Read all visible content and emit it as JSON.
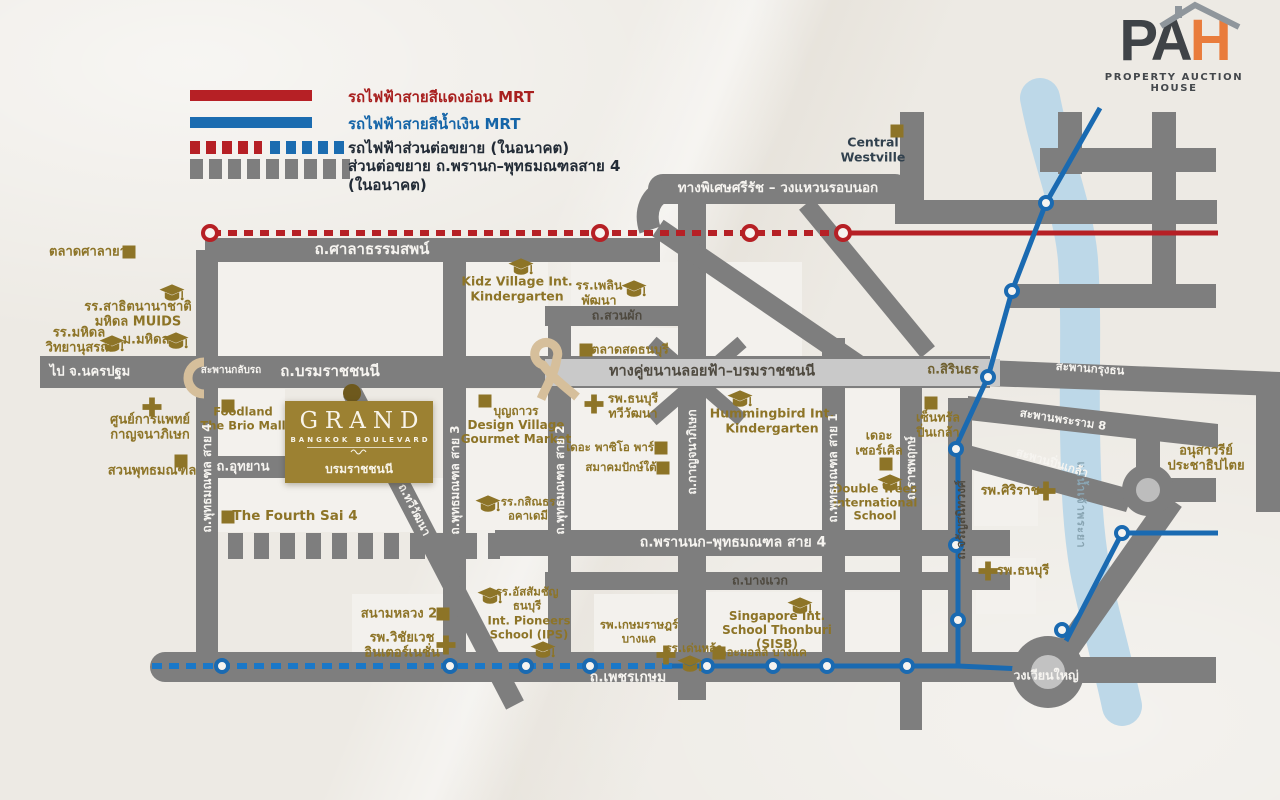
{
  "logo": {
    "part1": "PA",
    "part2": "H",
    "subtitle": "PROPERTY AUCTION HOUSE"
  },
  "legend": {
    "items": [
      {
        "id": "legend-red-line",
        "label": "รถไฟฟ้าสายสีแดงอ่อน MRT"
      },
      {
        "id": "legend-blue-line",
        "label": "รถไฟฟ้าสายสีน้ำเงิน MRT"
      },
      {
        "id": "legend-future-rail-extension",
        "label": "รถไฟฟ้าส่วนต่อขยาย (ในอนาคต)"
      },
      {
        "id": "legend-road-extension",
        "label": "ส่วนต่อขยาย ถ.พรานก–พุทธมณฑลสาย 4\n(ในอนาคต)"
      }
    ]
  },
  "project": {
    "name": "GRAND",
    "tagline": "BANGKOK BOULEVARD",
    "location": "บรมราชชนนี"
  },
  "colors": {
    "red_line": "#b62025",
    "blue_line": "#1a6ab1",
    "blue_line_future": "#1a78c8",
    "road": "#7e7e7e",
    "elevated_road": "#c9c9c9",
    "river": "#bdd8e8",
    "gold": "#8d7427",
    "project_box": "#9c8132",
    "logo_orange": "#e97c3c",
    "logo_dark": "#3f4347",
    "background": "#edeae4"
  },
  "map": {
    "labels": [
      {
        "id": "label-talad-salaya",
        "t": [
          "ตลาดศาลายา"
        ],
        "x": 88,
        "y": 252,
        "fs": 13,
        "cls": "gold"
      },
      {
        "id": "label-satit-muids",
        "t": [
          "รร.สาธิตนานาชาติ",
          "มหิดล MUIDS"
        ],
        "x": 138,
        "y": 315,
        "fs": 13,
        "cls": "gold"
      },
      {
        "id": "label-mahidol-wittayanusorn",
        "t": [
          "รร.มหิดล",
          "วิทยานุสรณ์"
        ],
        "x": 79,
        "y": 341,
        "fs": 13,
        "cls": "gold"
      },
      {
        "id": "label-mahidol-university",
        "t": [
          "ม.มหิดล"
        ],
        "x": 146,
        "y": 340,
        "fs": 13,
        "cls": "gold"
      },
      {
        "id": "label-road-salathammasop",
        "t": [
          "ถ.ศาลาธรรมสพน์"
        ],
        "x": 372,
        "y": 250,
        "fs": 15,
        "cls": "white"
      },
      {
        "id": "label-to-nakhonpathom",
        "t": [
          "ไป จ.นครปฐม"
        ],
        "x": 90,
        "y": 372,
        "fs": 13,
        "cls": "white"
      },
      {
        "id": "label-uturn-bridge",
        "t": [
          "สะพานกลับรถ"
        ],
        "x": 231,
        "y": 371,
        "fs": 10,
        "cls": "white"
      },
      {
        "id": "label-road-borommaratchachonnani",
        "t": [
          "ถ.บรมราชชนนี"
        ],
        "x": 330,
        "y": 372,
        "fs": 15,
        "cls": "white"
      },
      {
        "id": "label-kanchanaphisek-medical-center",
        "t": [
          "ศูนย์การแพทย์",
          "กาญจนาภิเษก"
        ],
        "x": 150,
        "y": 428,
        "fs": 13,
        "cls": "gold"
      },
      {
        "id": "label-phutthamonthon-park",
        "t": [
          "สวนพุทธมณฑล"
        ],
        "x": 152,
        "y": 471,
        "fs": 13,
        "cls": "gold"
      },
      {
        "id": "label-foodland-brio-mall",
        "t": [
          "Foodland",
          "The Brio Mall"
        ],
        "x": 243,
        "y": 419,
        "fs": 11.5,
        "cls": "gold"
      },
      {
        "id": "label-road-phutthamonthon-sai4",
        "t": [
          "ถ.พุทธมณฑล สาย 4"
        ],
        "x": 207,
        "y": 478,
        "fs": 12,
        "cls": "white",
        "rot": -90
      },
      {
        "id": "label-road-utthayan",
        "t": [
          "ถ.อุทยาน"
        ],
        "x": 243,
        "y": 467,
        "fs": 13,
        "cls": "white"
      },
      {
        "id": "label-the-fourth-sai4",
        "t": [
          "The Fourth Sai 4"
        ],
        "x": 295,
        "y": 517,
        "fs": 13.5,
        "cls": "gold"
      },
      {
        "id": "label-boonthavorn-design-village",
        "t": [
          "บุญถาวร",
          "Design Village",
          "Gourmet Market"
        ],
        "x": 516,
        "y": 425,
        "fs": 12,
        "cls": "gold"
      },
      {
        "id": "label-road-phutthamonthon-sai3",
        "t": [
          "ถ.พุทธมณฑล สาย 3"
        ],
        "x": 455,
        "y": 480,
        "fs": 12,
        "cls": "white",
        "rot": -90
      },
      {
        "id": "label-kasintorn-academy",
        "t": [
          "รร.กสิณธร",
          "อคาเดมี"
        ],
        "x": 528,
        "y": 509,
        "fs": 11.5,
        "cls": "gold"
      },
      {
        "id": "label-kidz-village",
        "t": [
          "Kidz Village Int.",
          "Kindergarten"
        ],
        "x": 517,
        "y": 289,
        "fs": 12.5,
        "cls": "gold"
      },
      {
        "id": "label-plearnpattana-school",
        "t": [
          "รร.เพลิน",
          "พัฒนา"
        ],
        "x": 599,
        "y": 293,
        "fs": 12.5,
        "cls": "gold"
      },
      {
        "id": "label-road-suanphak",
        "t": [
          "ถ.สวนผัก"
        ],
        "x": 617,
        "y": 316,
        "fs": 12.5,
        "cls": "dark"
      },
      {
        "id": "label-talad-sod-thonburi",
        "t": [
          "ตลาดสดธนบุรี"
        ],
        "x": 630,
        "y": 350,
        "fs": 12.5,
        "cls": "gold"
      },
      {
        "id": "label-elevated-parallel-road",
        "t": [
          "ทางคู่ขนานลอยฟ้า–บรมราชชนนี"
        ],
        "x": 712,
        "y": 372,
        "fs": 14.5,
        "cls": "dark"
      },
      {
        "id": "label-road-sirindhorn",
        "t": [
          "ถ.สิรินธร"
        ],
        "x": 953,
        "y": 370,
        "fs": 13,
        "cls": "goldd"
      },
      {
        "id": "label-thonburi-thawiwatthana-hospital",
        "t": [
          "รพ.ธนบุรี",
          "ทวีวัฒนา"
        ],
        "x": 633,
        "y": 406,
        "fs": 12.5,
        "cls": "gold"
      },
      {
        "id": "label-the-paseo-park",
        "t": [
          "เดอะ พาซิโอ พาร์ค"
        ],
        "x": 614,
        "y": 448,
        "fs": 11.5,
        "cls": "gold"
      },
      {
        "id": "label-southern-association",
        "t": [
          "สมาคมปักษ์ใต้"
        ],
        "x": 621,
        "y": 468,
        "fs": 11.5,
        "cls": "gold"
      },
      {
        "id": "label-road-phutthamonthon-sai2",
        "t": [
          "ถ.พุทธมณฑล สาย 2"
        ],
        "x": 560,
        "y": 480,
        "fs": 12,
        "cls": "white",
        "rot": -90
      },
      {
        "id": "label-road-kanchanaphisek",
        "t": [
          "ถ.กาญจนาภิเษก"
        ],
        "x": 692,
        "y": 452,
        "fs": 12,
        "cls": "white",
        "rot": -90
      },
      {
        "id": "label-hummingbird-kindergarten",
        "t": [
          "Hummingbird Int.",
          "Kindergarten"
        ],
        "x": 772,
        "y": 421,
        "fs": 12.5,
        "cls": "gold"
      },
      {
        "id": "label-the-circle",
        "t": [
          "เดอะ",
          "เซอร์เคิล"
        ],
        "x": 879,
        "y": 443,
        "fs": 12.5,
        "cls": "gold"
      },
      {
        "id": "label-double-trees-school",
        "t": [
          "Double Trees",
          "International",
          "School"
        ],
        "x": 875,
        "y": 503,
        "fs": 11.5,
        "cls": "gold"
      },
      {
        "id": "label-road-phutthamonthon-sai1",
        "t": [
          "ถ.พุทธมณฑล สาย 1"
        ],
        "x": 833,
        "y": 468,
        "fs": 12,
        "cls": "white",
        "rot": -90
      },
      {
        "id": "label-road-ratchaphruek",
        "t": [
          "ถ.ราชพฤกษ์"
        ],
        "x": 911,
        "y": 468,
        "fs": 12,
        "cls": "white",
        "rot": -90
      },
      {
        "id": "label-central-pinklao",
        "t": [
          "เซ็นทรัล",
          "ปิ่นเกล้า"
        ],
        "x": 938,
        "y": 425,
        "fs": 12.5,
        "cls": "gold"
      },
      {
        "id": "label-road-charansanitwong",
        "t": [
          "ถ.จรัญสนิทวงศ์"
        ],
        "x": 961,
        "y": 520,
        "fs": 12,
        "cls": "dark",
        "rot": -90
      },
      {
        "id": "label-siriraj-hospital",
        "t": [
          "รพ.ศิริราช"
        ],
        "x": 1010,
        "y": 491,
        "fs": 13,
        "cls": "gold"
      },
      {
        "id": "label-thonburi-hospital",
        "t": [
          "รพ.ธนบุรี"
        ],
        "x": 1023,
        "y": 571,
        "fs": 13,
        "cls": "gold"
      },
      {
        "id": "label-chaophraya-river",
        "t": [
          "แม่น้ำเจ้าพระยา"
        ],
        "x": 1080,
        "y": 505,
        "fs": 11,
        "cls": "river",
        "rot": 90
      },
      {
        "id": "label-krungthon-bridge",
        "t": [
          "สะพานกรุงธน"
        ],
        "x": 1090,
        "y": 369,
        "fs": 11.5,
        "cls": "white",
        "rot": 4
      },
      {
        "id": "label-rama8-bridge",
        "t": [
          "สะพานพระราม 8"
        ],
        "x": 1063,
        "y": 420,
        "fs": 11.5,
        "cls": "white",
        "rot": 9
      },
      {
        "id": "label-pinklao-bridge",
        "t": [
          "สะพานปิ่นเกล้า"
        ],
        "x": 1052,
        "y": 463,
        "fs": 11.5,
        "cls": "white",
        "rot": 17
      },
      {
        "id": "label-democracy-monument",
        "t": [
          "อนุสาวรีย์",
          "ประชาธิปไตย"
        ],
        "x": 1206,
        "y": 459,
        "fs": 13,
        "cls": "gold"
      },
      {
        "id": "label-central-westville",
        "t": [
          "Central",
          "Westville"
        ],
        "x": 873,
        "y": 150,
        "fs": 12.5,
        "cls": "navy"
      },
      {
        "id": "label-srirat-expressway",
        "t": [
          "ทางพิเศษศรีรัช – วงแหวนรอบนอก"
        ],
        "x": 778,
        "y": 189,
        "fs": 13.5,
        "cls": "white"
      },
      {
        "id": "label-sanamluang2",
        "t": [
          "สนามหลวง 2"
        ],
        "x": 399,
        "y": 614,
        "fs": 13,
        "cls": "gold"
      },
      {
        "id": "label-vichaivej-hospital",
        "t": [
          "รพ.วิชัยเวช",
          "อินเตอร์เนชั่น"
        ],
        "x": 402,
        "y": 646,
        "fs": 13,
        "cls": "gold"
      },
      {
        "id": "label-assumption-thonburi",
        "t": [
          "รร.อัสสัมชัญ",
          "ธนบุรี"
        ],
        "x": 527,
        "y": 599,
        "fs": 11.5,
        "cls": "gold"
      },
      {
        "id": "label-int-pioneers-school",
        "t": [
          "Int. Pioneers",
          "School (IPS)"
        ],
        "x": 529,
        "y": 628,
        "fs": 11.5,
        "cls": "gold"
      },
      {
        "id": "label-denla-school",
        "t": [
          "รร.เด่นหล้า"
        ],
        "x": 694,
        "y": 649,
        "fs": 11.5,
        "cls": "gold"
      },
      {
        "id": "label-kasemrad-bangkae",
        "t": [
          "รพ.เกษมราษฎร์",
          "บางแค"
        ],
        "x": 639,
        "y": 632,
        "fs": 11.5,
        "cls": "gold"
      },
      {
        "id": "label-sisb",
        "t": [
          "Singapore Int.",
          "School Thonburi",
          "(SISB)"
        ],
        "x": 777,
        "y": 630,
        "fs": 12,
        "cls": "gold"
      },
      {
        "id": "label-the-mall-bangkae",
        "t": [
          "เดอะมอลล์ บางแค"
        ],
        "x": 761,
        "y": 653,
        "fs": 11.5,
        "cls": "gold"
      },
      {
        "id": "label-road-prannok",
        "t": [
          "ถ.พรานนก–พุทธมณฑล สาย 4"
        ],
        "x": 733,
        "y": 543,
        "fs": 14,
        "cls": "white"
      },
      {
        "id": "label-road-bangwaek",
        "t": [
          "ถ.บางแวก"
        ],
        "x": 760,
        "y": 581,
        "fs": 12.5,
        "cls": "dark"
      },
      {
        "id": "label-road-phetkasem",
        "t": [
          "ถ.เพชรเกษม"
        ],
        "x": 628,
        "y": 678,
        "fs": 14,
        "cls": "white"
      },
      {
        "id": "label-wongwianyai",
        "t": [
          "วงเวียนใหญ่"
        ],
        "x": 1046,
        "y": 676,
        "fs": 12.5,
        "cls": "white"
      },
      {
        "id": "label-road-thawiwatthana",
        "t": [
          "ถ.ทวีวัฒนา"
        ],
        "x": 414,
        "y": 510,
        "fs": 11.5,
        "cls": "white",
        "rot": 63
      }
    ],
    "icons": [
      {
        "k": "sq",
        "x": 129,
        "y": 252
      },
      {
        "k": "cap",
        "x": 172,
        "y": 293
      },
      {
        "k": "cap",
        "x": 112,
        "y": 344
      },
      {
        "k": "cap",
        "x": 176,
        "y": 341
      },
      {
        "k": "cross",
        "x": 152,
        "y": 407
      },
      {
        "k": "sq",
        "x": 181,
        "y": 461
      },
      {
        "k": "sq",
        "x": 228,
        "y": 406
      },
      {
        "k": "sq",
        "x": 228,
        "y": 517
      },
      {
        "k": "sq",
        "x": 485,
        "y": 401
      },
      {
        "k": "cap",
        "x": 521,
        "y": 267
      },
      {
        "k": "cap",
        "x": 634,
        "y": 289
      },
      {
        "k": "cap",
        "x": 488,
        "y": 504
      },
      {
        "k": "sq",
        "x": 586,
        "y": 350
      },
      {
        "k": "cross",
        "x": 594,
        "y": 404
      },
      {
        "k": "sq",
        "x": 661,
        "y": 448
      },
      {
        "k": "sq",
        "x": 663,
        "y": 468
      },
      {
        "k": "cap",
        "x": 740,
        "y": 399
      },
      {
        "k": "sq",
        "x": 886,
        "y": 464
      },
      {
        "k": "cap",
        "x": 890,
        "y": 483
      },
      {
        "k": "sq",
        "x": 931,
        "y": 403
      },
      {
        "k": "cross",
        "x": 1046,
        "y": 491
      },
      {
        "k": "cross",
        "x": 988,
        "y": 571
      },
      {
        "k": "sq",
        "x": 897,
        "y": 131
      },
      {
        "k": "sq",
        "x": 443,
        "y": 614
      },
      {
        "k": "cross",
        "x": 446,
        "y": 645
      },
      {
        "k": "cap",
        "x": 490,
        "y": 596
      },
      {
        "k": "cap",
        "x": 543,
        "y": 650
      },
      {
        "k": "cap",
        "x": 690,
        "y": 664
      },
      {
        "k": "cross",
        "x": 666,
        "y": 655
      },
      {
        "k": "cap",
        "x": 800,
        "y": 606
      },
      {
        "k": "sq",
        "x": 719,
        "y": 653
      }
    ],
    "stations": {
      "red": [
        [
          210,
          233
        ],
        [
          600,
          233
        ],
        [
          750,
          233
        ],
        [
          843,
          233
        ]
      ],
      "blue": [
        [
          1046,
          203
        ],
        [
          1012,
          291
        ],
        [
          988,
          377
        ],
        [
          956,
          449
        ],
        [
          956,
          545
        ],
        [
          958,
          620
        ],
        [
          907,
          666
        ],
        [
          827,
          666
        ],
        [
          773,
          666
        ],
        [
          707,
          666
        ],
        [
          590,
          666
        ],
        [
          526,
          666
        ],
        [
          450,
          666
        ],
        [
          222,
          666
        ],
        [
          1062,
          630
        ],
        [
          1122,
          533
        ]
      ]
    }
  }
}
